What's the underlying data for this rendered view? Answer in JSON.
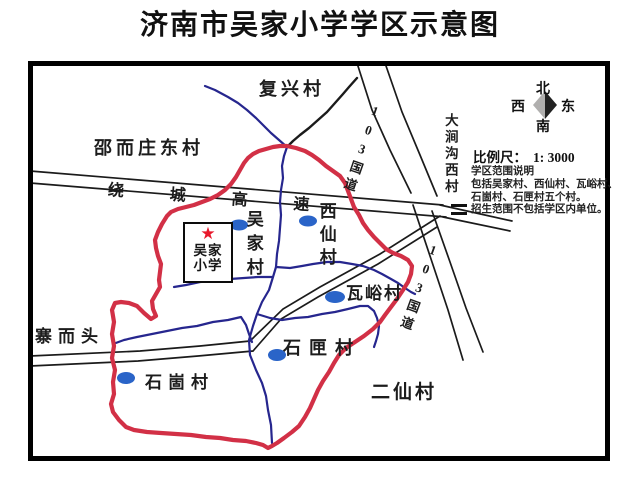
{
  "title": "济南市吴家小学学区示意图",
  "colors": {
    "boundary": "#d23046",
    "river": "#26268e",
    "dot": "#2a64c8",
    "road": "#1b1b1b",
    "star": "#e8192c",
    "compass_light": "#b0afae",
    "compass_dark": "#222222"
  },
  "compass": {
    "north": "北",
    "south": "南",
    "east": "东",
    "west": "西"
  },
  "scale": {
    "label": "比例尺：",
    "value": "1: 3000"
  },
  "notes": {
    "line1": "学区范围说明",
    "line2": "包括吴家村、西仙村、瓦峪村、",
    "line3": "石崮村、石匣村五个村。",
    "line4": "招生范围不包括学区内单位。"
  },
  "school": {
    "star": "★",
    "name_line1": "吴家",
    "name_line2": "小学"
  },
  "roads": {
    "ring_expressway": "绕城高速",
    "national_road_upper": "103国道",
    "national_road_lower": "103国道"
  },
  "villages": {
    "fuxing": "复兴村",
    "shaoerzhuang_east": "邵而庄东村",
    "zhaiertou": "寨而头",
    "wujia": "吴家村",
    "xixian": "西仙村",
    "wayu": "瓦峪村",
    "shixia": "石匣村",
    "shigu": "石崮村",
    "erxian": "二仙村",
    "dajiangou_west": "大涧沟西村"
  }
}
